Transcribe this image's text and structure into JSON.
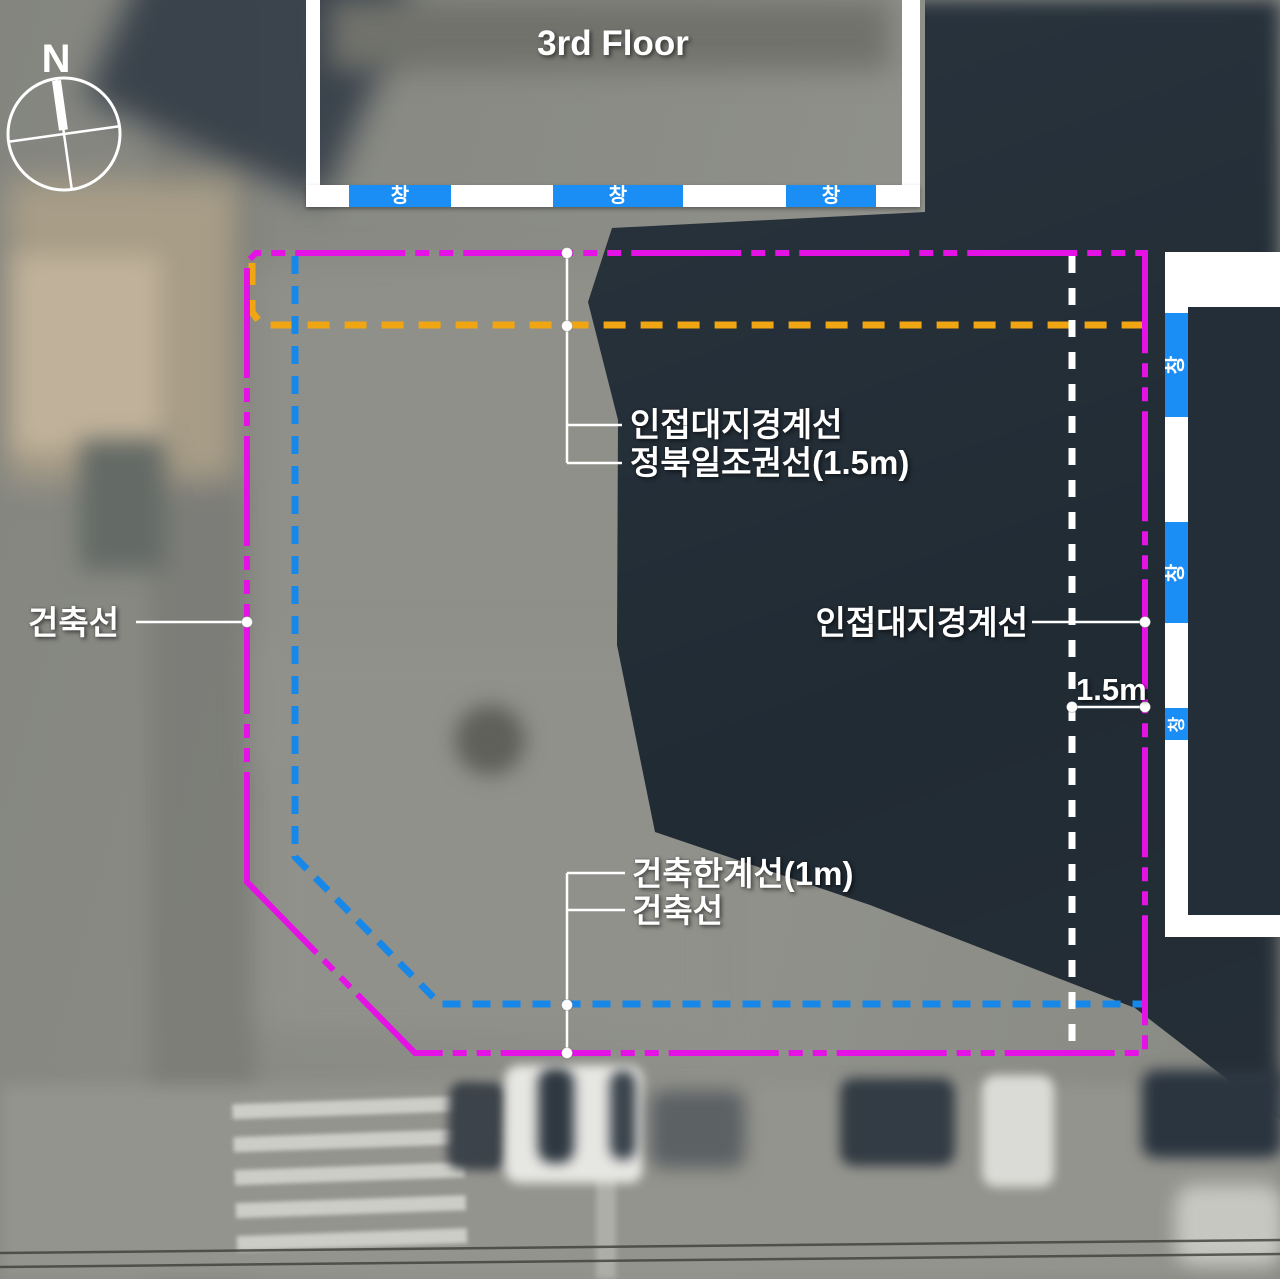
{
  "compass": {
    "label": "N"
  },
  "top_building": {
    "title": "3rd Floor",
    "windows": [
      "창",
      "창",
      "창"
    ]
  },
  "right_building": {
    "windows": [
      "창",
      "창",
      "창"
    ]
  },
  "annotations": {
    "top": {
      "boundary": "인접대지경계선",
      "sunlight": "정북일조권선(1.5m)"
    },
    "left": {
      "building_line": "건축선"
    },
    "right": {
      "boundary": "인접대지경계선",
      "offset": "1.5m"
    },
    "bottom": {
      "limit_line": "건축한계선(1m)",
      "building_line": "건축선"
    }
  },
  "colors": {
    "site_boundary": "#e512e5",
    "building_limit": "#1787e8",
    "sunlight_line": "#f0a513",
    "offset_guide": "#ffffff",
    "window_box": "#1b8ef5",
    "leader": "#ffffff"
  }
}
